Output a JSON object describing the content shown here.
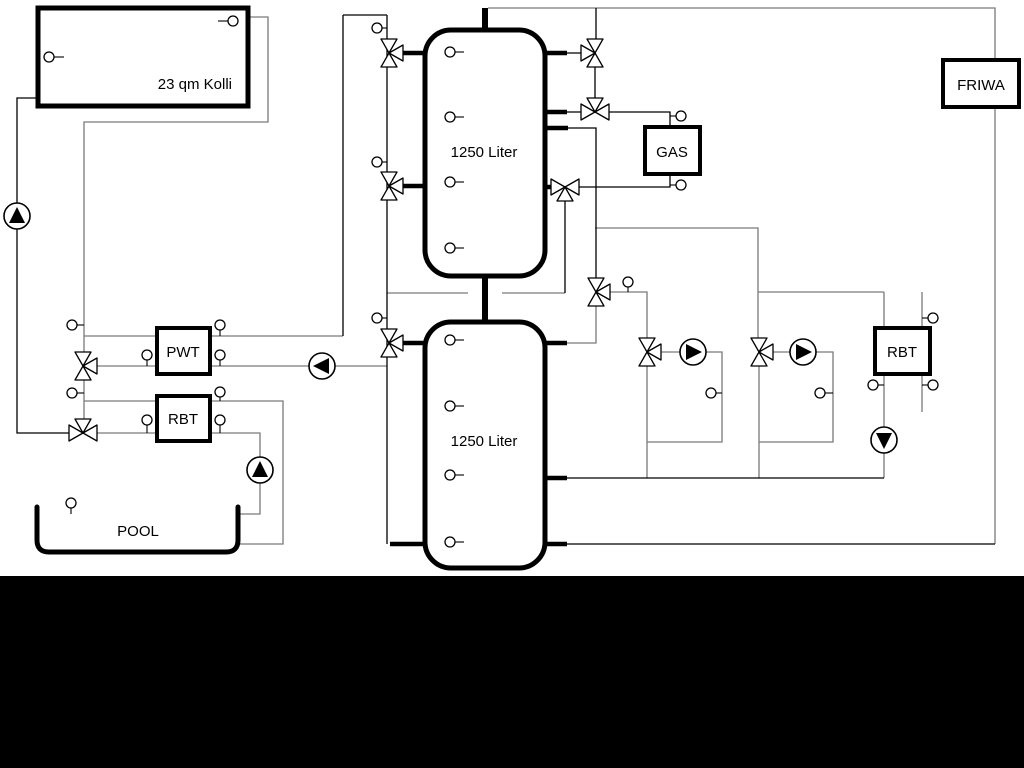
{
  "page": {
    "background": "#ffffff",
    "bottom_band_color": "#000000"
  },
  "diagram": {
    "labels": {
      "collector": "23 qm Kolli",
      "tank_top": "1250 Liter",
      "tank_bottom": "1250 Liter",
      "pwt": "PWT",
      "rbt_left": "RBT",
      "gas": "GAS",
      "friwa": "FRIWA",
      "rbt_right": "RBT",
      "pool": "POOL"
    },
    "colors": {
      "pipe_gray": "#7a7a7a",
      "pipe_black": "#000000",
      "component_fill": "#ffffff",
      "component_stroke": "#000000"
    },
    "component_counts": {
      "storage_tanks": 2,
      "pumps": 6,
      "three_way_valves": 11,
      "temperature_sensors": 30
    }
  }
}
